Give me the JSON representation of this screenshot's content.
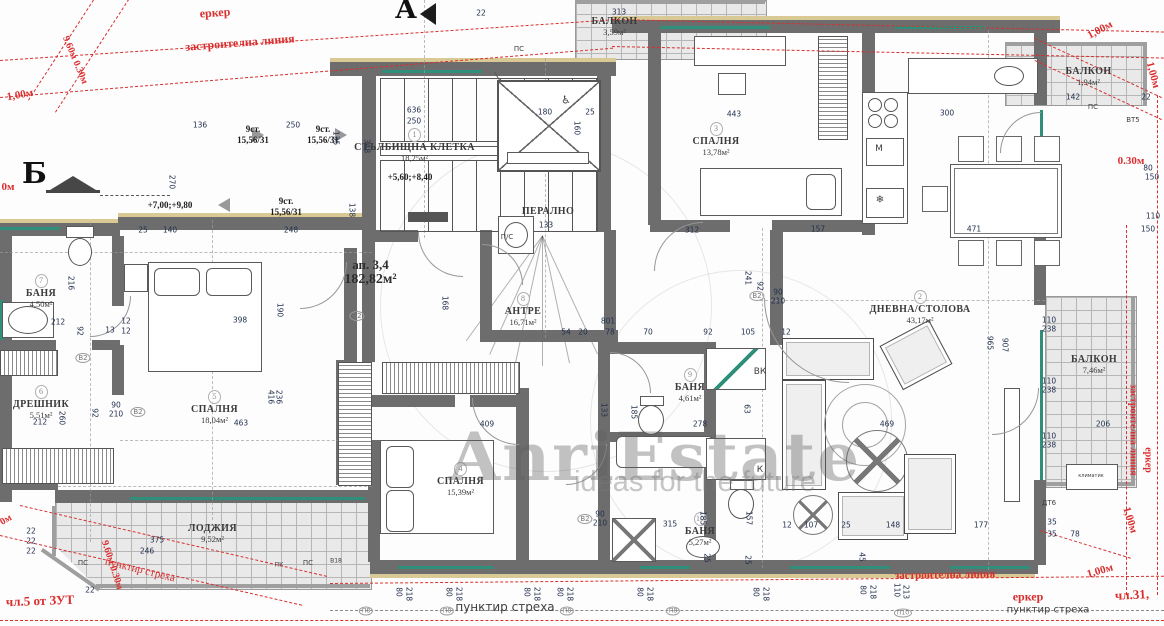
{
  "watermark": {
    "brand": "AnriEstate",
    "tagline": "ideas for the future"
  },
  "markers": {
    "section_a": "А",
    "section_b": "Б"
  },
  "apartment": {
    "number": "ап. 3,4",
    "area": "182,82м²"
  },
  "stairs": {
    "flights": [
      {
        "steps": "9ст.",
        "ratio": "15,56/31"
      },
      {
        "steps": "9ст.",
        "ratio": "15,56/31"
      },
      {
        "steps": "9ст.",
        "ratio": "15,56/31"
      }
    ],
    "level_a": "+7,00;+9,80",
    "level_b": "+5,60;+8,40"
  },
  "rooms": [
    {
      "num": "1",
      "name": "СТЪЛБИЩНА КЛЕТКА",
      "area": "18,25м²"
    },
    {
      "num": "2",
      "name": "ДНЕВНА/СТОЛОВА",
      "area": "43,17м²"
    },
    {
      "num": "3",
      "name": "СПАЛНЯ",
      "area": "13,78м²"
    },
    {
      "num": "4",
      "name": "СПАЛНЯ",
      "area": "15,39м²"
    },
    {
      "num": "5",
      "name": "СПАЛНЯ",
      "area": "18,04м²"
    },
    {
      "num": "6",
      "name": "ДРЕШНИК",
      "area": "5,51м²"
    },
    {
      "num": "7",
      "name": "БАНЯ",
      "area": "4,50м²"
    },
    {
      "num": "8",
      "name": "АНТРЕ",
      "area": "16,71м²"
    },
    {
      "num": "9",
      "name": "БАНЯ",
      "area": "4,61м²"
    },
    {
      "num": "10",
      "name": "БАНЯ",
      "area": "5,27м²"
    },
    {
      "num": "",
      "name": "ПЕРАЛНО",
      "area": ""
    },
    {
      "num": "",
      "name": "ЛОДЖИЯ",
      "area": "9,52м²"
    },
    {
      "num": "",
      "name": "БАЛКОН",
      "area": "3,59м²"
    },
    {
      "num": "",
      "name": "БАЛКОН",
      "area": "1,94м²"
    },
    {
      "num": "",
      "name": "БАЛКОН",
      "area": "7,46м²"
    }
  ],
  "red_notes": [
    {
      "t": "еркер",
      "x": 215,
      "y": 13,
      "r": -4,
      "s": 12,
      "b": 1
    },
    {
      "t": "застроителна линия",
      "x": 240,
      "y": 43,
      "r": -4.5,
      "s": 12,
      "b": 1
    },
    {
      "t": "9.60м 0.30м",
      "x": 75,
      "y": 60,
      "r": 67,
      "s": 10,
      "b": 1
    },
    {
      "t": "1,00м",
      "x": 20,
      "y": 95,
      "r": -10,
      "s": 11,
      "b": 1
    },
    {
      "t": "0м",
      "x": 8,
      "y": 187,
      "r": 0,
      "s": 11,
      "b": 1
    },
    {
      "t": "1,00м",
      "x": 1100,
      "y": 30,
      "r": -28,
      "s": 11,
      "b": 1
    },
    {
      "t": "1,00м",
      "x": 1153,
      "y": 75,
      "r": 75,
      "s": 11,
      "b": 1
    },
    {
      "t": "0.30м",
      "x": 1131,
      "y": 161,
      "r": 0,
      "s": 11,
      "b": 1
    },
    {
      "t": "застроителна линия",
      "x": 1133,
      "y": 430,
      "r": 90,
      "s": 10,
      "b": 1
    },
    {
      "t": "еркер",
      "x": 1148,
      "y": 460,
      "r": 90,
      "s": 10,
      "b": 1
    },
    {
      "t": "пунктир стреха",
      "x": 140,
      "y": 570,
      "r": 14,
      "s": 11,
      "b": 0
    },
    {
      "t": "чл.5 от ЗУТ",
      "x": 40,
      "y": 601,
      "r": -2,
      "s": 13,
      "b": 1
    },
    {
      "t": "застроителна линия",
      "x": 945,
      "y": 575,
      "r": -1,
      "s": 11,
      "b": 1
    },
    {
      "t": "еркер",
      "x": 1028,
      "y": 597,
      "r": 0,
      "s": 12,
      "b": 1
    },
    {
      "t": "чл.31,",
      "x": 1132,
      "y": 595,
      "r": -3,
      "s": 13,
      "b": 1
    },
    {
      "t": "1,00м",
      "x": 1100,
      "y": 571,
      "r": -16,
      "s": 11,
      "b": 1
    },
    {
      "t": "1,00м",
      "x": 1130,
      "y": 520,
      "r": 73,
      "s": 11,
      "b": 1
    },
    {
      "t": "0м",
      "x": 6,
      "y": 520,
      "r": -30,
      "s": 10,
      "b": 1
    },
    {
      "t": "9.60м 0.30м",
      "x": 112,
      "y": 565,
      "r": 72,
      "s": 10,
      "b": 1
    }
  ],
  "notes": [
    {
      "t": "пунктир стреха",
      "x": 505,
      "y": 607,
      "s": 12
    },
    {
      "t": "пунктир стреха",
      "x": 1048,
      "y": 610,
      "s": 10
    },
    {
      "t": "ПС",
      "x": 83,
      "y": 563,
      "s": 7
    },
    {
      "t": "ПС",
      "x": 308,
      "y": 563,
      "s": 7
    },
    {
      "t": "ПС",
      "x": 1093,
      "y": 107,
      "s": 7
    },
    {
      "t": "ПС",
      "x": 519,
      "y": 49,
      "s": 7
    },
    {
      "t": "ВК",
      "x": 760,
      "y": 372,
      "s": 9
    },
    {
      "t": "К",
      "x": 760,
      "y": 470,
      "s": 9
    },
    {
      "t": "М",
      "x": 879,
      "y": 149,
      "s": 9
    },
    {
      "t": "❄",
      "x": 880,
      "y": 200,
      "s": 10
    },
    {
      "t": "П/С",
      "x": 507,
      "y": 237,
      "s": 7
    },
    {
      "t": "В18",
      "x": 336,
      "y": 561,
      "s": 6
    },
    {
      "t": "ПК",
      "x": 279,
      "y": 565,
      "s": 6
    },
    {
      "t": "ДТ6",
      "x": 1049,
      "y": 503,
      "s": 7
    },
    {
      "t": "ВТ5",
      "x": 1133,
      "y": 120,
      "s": 7
    },
    {
      "t": "климатик",
      "x": 1091,
      "y": 476,
      "s": 5
    },
    {
      "t": "♿",
      "x": 566,
      "y": 100,
      "s": 11
    },
    {
      "t": "В2",
      "x": 83,
      "y": 358,
      "s": 7,
      "tag": 1
    },
    {
      "t": "В2",
      "x": 138,
      "y": 412,
      "s": 7,
      "tag": 1
    },
    {
      "t": "В2",
      "x": 357,
      "y": 316,
      "s": 7,
      "tag": 1
    },
    {
      "t": "В2",
      "x": 757,
      "y": 296,
      "s": 7,
      "tag": 1
    },
    {
      "t": "В2",
      "x": 585,
      "y": 519,
      "s": 7,
      "tag": 1
    },
    {
      "t": "П8",
      "x": 366,
      "y": 611,
      "s": 6,
      "tag": 1
    },
    {
      "t": "П8",
      "x": 447,
      "y": 611,
      "s": 6,
      "tag": 1
    },
    {
      "t": "П8",
      "x": 567,
      "y": 611,
      "s": 6,
      "tag": 1
    },
    {
      "t": "П8",
      "x": 673,
      "y": 611,
      "s": 6,
      "tag": 1
    },
    {
      "t": "П10",
      "x": 903,
      "y": 613,
      "s": 6,
      "tag": 1
    }
  ],
  "dims": [
    {
      "t": "136",
      "x": 200,
      "y": 125
    },
    {
      "t": "250",
      "x": 293,
      "y": 125
    },
    {
      "t": "25",
      "x": 143,
      "y": 230
    },
    {
      "t": "140",
      "x": 170,
      "y": 230
    },
    {
      "t": "248",
      "x": 291,
      "y": 230
    },
    {
      "t": "270",
      "x": 172,
      "y": 182,
      "r": 90
    },
    {
      "t": "135",
      "x": 336,
      "y": 138,
      "r": 90
    },
    {
      "t": "138",
      "x": 352,
      "y": 210,
      "r": 90
    },
    {
      "t": "348",
      "x": 367,
      "y": 146,
      "r": 90
    },
    {
      "t": "636",
      "x": 414,
      "y": 110
    },
    {
      "t": "250",
      "x": 414,
      "y": 121
    },
    {
      "t": "22",
      "x": 481,
      "y": 13
    },
    {
      "t": "313",
      "x": 619,
      "y": 12
    },
    {
      "t": "180",
      "x": 545,
      "y": 112
    },
    {
      "t": "25",
      "x": 590,
      "y": 112
    },
    {
      "t": "160",
      "x": 577,
      "y": 128,
      "r": 90
    },
    {
      "t": "443",
      "x": 734,
      "y": 114
    },
    {
      "t": "312",
      "x": 692,
      "y": 230
    },
    {
      "t": "157",
      "x": 818,
      "y": 229
    },
    {
      "t": "300",
      "x": 947,
      "y": 113
    },
    {
      "t": "471",
      "x": 974,
      "y": 229
    },
    {
      "t": "142",
      "x": 1073,
      "y": 97
    },
    {
      "t": "22",
      "x": 1146,
      "y": 97
    },
    {
      "t": "110",
      "x": 1049,
      "y": 320
    },
    {
      "t": "238",
      "x": 1049,
      "y": 329
    },
    {
      "t": "110",
      "x": 1049,
      "y": 381
    },
    {
      "t": "238",
      "x": 1049,
      "y": 390
    },
    {
      "t": "110",
      "x": 1049,
      "y": 436
    },
    {
      "t": "238",
      "x": 1049,
      "y": 445
    },
    {
      "t": "80",
      "x": 1148,
      "y": 168
    },
    {
      "t": "150",
      "x": 1152,
      "y": 177
    },
    {
      "t": "110",
      "x": 1153,
      "y": 216
    },
    {
      "t": "150",
      "x": 1148,
      "y": 229
    },
    {
      "t": "965",
      "x": 990,
      "y": 343,
      "r": 90
    },
    {
      "t": "907",
      "x": 1005,
      "y": 345,
      "r": 90
    },
    {
      "t": "469",
      "x": 887,
      "y": 424
    },
    {
      "t": "206",
      "x": 1103,
      "y": 424
    },
    {
      "t": "241",
      "x": 748,
      "y": 278,
      "r": 90
    },
    {
      "t": "92",
      "x": 760,
      "y": 286,
      "r": 90
    },
    {
      "t": "90",
      "x": 778,
      "y": 292
    },
    {
      "t": "210",
      "x": 778,
      "y": 301
    },
    {
      "t": "212",
      "x": 58,
      "y": 322
    },
    {
      "t": "92",
      "x": 80,
      "y": 331,
      "r": 90
    },
    {
      "t": "12",
      "x": 126,
      "y": 321
    },
    {
      "t": "13",
      "x": 110,
      "y": 330
    },
    {
      "t": "12",
      "x": 126,
      "y": 331
    },
    {
      "t": "398",
      "x": 240,
      "y": 320
    },
    {
      "t": "190",
      "x": 280,
      "y": 310,
      "r": 90
    },
    {
      "t": "216",
      "x": 71,
      "y": 283,
      "r": 90
    },
    {
      "t": "212",
      "x": 40,
      "y": 422
    },
    {
      "t": "92",
      "x": 95,
      "y": 413,
      "r": 90
    },
    {
      "t": "260",
      "x": 62,
      "y": 418,
      "r": 90
    },
    {
      "t": "463",
      "x": 241,
      "y": 423
    },
    {
      "t": "416",
      "x": 271,
      "y": 397,
      "r": 90
    },
    {
      "t": "236",
      "x": 279,
      "y": 397,
      "r": 90
    },
    {
      "t": "90",
      "x": 116,
      "y": 405
    },
    {
      "t": "210",
      "x": 116,
      "y": 414
    },
    {
      "t": "801",
      "x": 608,
      "y": 321
    },
    {
      "t": "54",
      "x": 566,
      "y": 332
    },
    {
      "t": "20",
      "x": 583,
      "y": 332
    },
    {
      "t": "78",
      "x": 610,
      "y": 332
    },
    {
      "t": "70",
      "x": 648,
      "y": 332
    },
    {
      "t": "92",
      "x": 708,
      "y": 332
    },
    {
      "t": "105",
      "x": 748,
      "y": 332
    },
    {
      "t": "12",
      "x": 786,
      "y": 332
    },
    {
      "t": "168",
      "x": 445,
      "y": 303,
      "r": 90
    },
    {
      "t": "409",
      "x": 487,
      "y": 424
    },
    {
      "t": "278",
      "x": 700,
      "y": 424
    },
    {
      "t": "133",
      "x": 604,
      "y": 410,
      "r": 90
    },
    {
      "t": "185",
      "x": 634,
      "y": 412,
      "r": 90
    },
    {
      "t": "63",
      "x": 747,
      "y": 409,
      "r": 90
    },
    {
      "t": "133",
      "x": 546,
      "y": 225
    },
    {
      "t": "90",
      "x": 600,
      "y": 514
    },
    {
      "t": "210",
      "x": 600,
      "y": 523
    },
    {
      "t": "315",
      "x": 670,
      "y": 524
    },
    {
      "t": "12",
      "x": 787,
      "y": 525
    },
    {
      "t": "107",
      "x": 811,
      "y": 525
    },
    {
      "t": "25",
      "x": 846,
      "y": 525
    },
    {
      "t": "148",
      "x": 893,
      "y": 525
    },
    {
      "t": "177",
      "x": 981,
      "y": 525
    },
    {
      "t": "35",
      "x": 1052,
      "y": 522
    },
    {
      "t": "35",
      "x": 1052,
      "y": 534
    },
    {
      "t": "78",
      "x": 1075,
      "y": 534
    },
    {
      "t": "157",
      "x": 749,
      "y": 518,
      "r": 90
    },
    {
      "t": "185",
      "x": 703,
      "y": 518,
      "r": 90
    },
    {
      "t": "25",
      "x": 707,
      "y": 558,
      "r": 90
    },
    {
      "t": "25",
      "x": 748,
      "y": 560,
      "r": 90
    },
    {
      "t": "45",
      "x": 862,
      "y": 557,
      "r": 90
    },
    {
      "t": "375",
      "x": 157,
      "y": 540
    },
    {
      "t": "246",
      "x": 147,
      "y": 551
    },
    {
      "t": "22",
      "x": 31,
      "y": 531
    },
    {
      "t": "22",
      "x": 31,
      "y": 541
    },
    {
      "t": "22",
      "x": 31,
      "y": 551
    },
    {
      "t": "22",
      "x": 90,
      "y": 590
    },
    {
      "t": "80",
      "x": 399,
      "y": 592,
      "r": 90
    },
    {
      "t": "218",
      "x": 409,
      "y": 594,
      "r": 90
    },
    {
      "t": "80",
      "x": 449,
      "y": 592,
      "r": 90
    },
    {
      "t": "218",
      "x": 459,
      "y": 594,
      "r": 90
    },
    {
      "t": "80",
      "x": 527,
      "y": 592,
      "r": 90
    },
    {
      "t": "218",
      "x": 537,
      "y": 594,
      "r": 90
    },
    {
      "t": "80",
      "x": 560,
      "y": 592,
      "r": 90
    },
    {
      "t": "218",
      "x": 570,
      "y": 594,
      "r": 90
    },
    {
      "t": "80",
      "x": 640,
      "y": 592,
      "r": 90
    },
    {
      "t": "218",
      "x": 650,
      "y": 594,
      "r": 90
    },
    {
      "t": "80",
      "x": 756,
      "y": 592,
      "r": 90
    },
    {
      "t": "218",
      "x": 766,
      "y": 594,
      "r": 90
    },
    {
      "t": "80",
      "x": 863,
      "y": 590,
      "r": 90
    },
    {
      "t": "218",
      "x": 873,
      "y": 592,
      "r": 90
    },
    {
      "t": "110",
      "x": 897,
      "y": 590,
      "r": 90
    },
    {
      "t": "213",
      "x": 906,
      "y": 592,
      "r": 90
    }
  ]
}
